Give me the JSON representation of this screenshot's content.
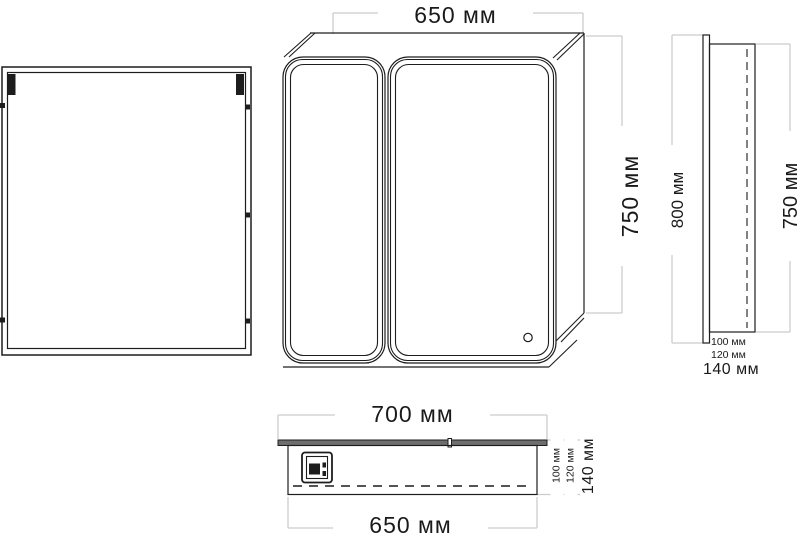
{
  "drawing_type": "mirror-cabinet-technical-drawing",
  "colors": {
    "background": "#ffffff",
    "line": "#1d1d1d",
    "dimension_line": "#cccccc",
    "text": "#1a1a1a"
  },
  "dimensions": {
    "front": {
      "width": "650 мм",
      "height": "750 мм"
    },
    "side": {
      "mirror_height": "800 мм",
      "body_height": "750 мм",
      "depth_body": "100 мм",
      "depth_mid": "120 мм",
      "depth_total": "140 мм"
    },
    "top": {
      "width_overall": "700 мм",
      "width_body": "650 мм",
      "depth_body": "100 мм",
      "depth_mid": "120 мм",
      "depth_total": "140 мм"
    }
  }
}
